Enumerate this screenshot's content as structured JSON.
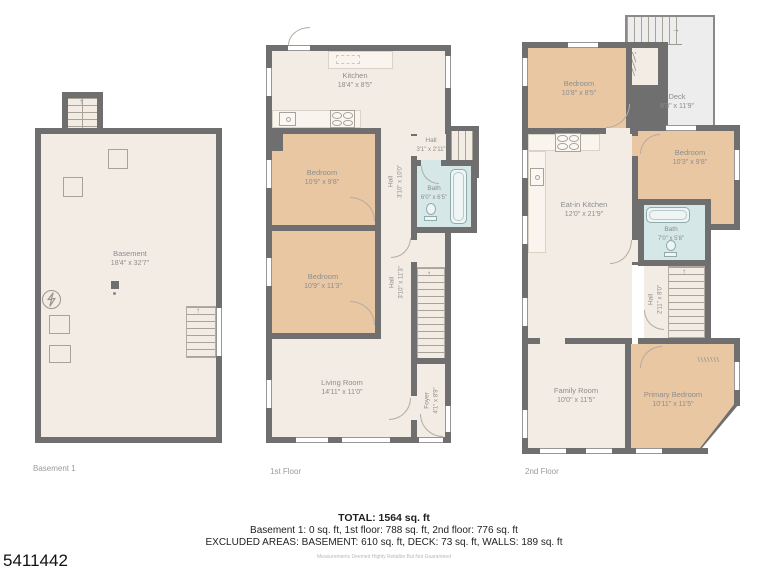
{
  "footer": {
    "total": "TOTAL: 1564 sq. ft",
    "breakdown": "Basement 1: 0 sq. ft, 1st floor: 788 sq. ft, 2nd floor: 776 sq. ft",
    "excluded": "EXCLUDED AREAS: BASEMENT: 610 sq. ft, DECK: 73 sq. ft, WALLS: 189 sq. ft",
    "disclaimer": "Measurements Deemed Highly Reliable But Not Guaranteed",
    "listing_number": "5411442"
  },
  "colors": {
    "wall": "#6f6f6f",
    "floor": "#f2ece5",
    "bedroom": "#eac7a3",
    "bath": "#d5e7e6",
    "deck": "#ededed",
    "label_text": "#8d8d8d"
  },
  "floors": [
    {
      "label": "Basement 1",
      "rooms": [
        {
          "name": "Basement",
          "dims": "18'4\" x 32'7\""
        }
      ]
    },
    {
      "label": "1st Floor",
      "rooms": [
        {
          "name": "Kitchen",
          "dims": "18'4\" x 8'5\""
        },
        {
          "name": "Bedroom",
          "dims": "10'9\" x 9'8\""
        },
        {
          "name": "Bedroom",
          "dims": "10'9\" x 11'3\""
        },
        {
          "name": "Living Room",
          "dims": "14'11\" x 11'0\""
        },
        {
          "name": "Hall",
          "dims": "3'1\" x 2'11\""
        },
        {
          "name": "Bath",
          "dims": "6'0\" x 6'5\""
        },
        {
          "name": "Hall",
          "dims": "3'10\" x 10'0\""
        },
        {
          "name": "Hall",
          "dims": "3'10\" x 11'3\""
        },
        {
          "name": "Foyer",
          "dims": "4'1\" x 8'9\""
        }
      ]
    },
    {
      "label": "2nd Floor",
      "rooms": [
        {
          "name": "Bedroom",
          "dims": "10'8\" x 8'5\""
        },
        {
          "name": "Deck",
          "dims": "8'3\" x 11'9\""
        },
        {
          "name": "Bedroom",
          "dims": "10'3\" x 9'8\""
        },
        {
          "name": "Eat-in Kitchen",
          "dims": "12'0\" x 21'9\""
        },
        {
          "name": "Bath",
          "dims": "7'0\" x 5'8\""
        },
        {
          "name": "Hall",
          "dims": "2'11\" x 8'0\""
        },
        {
          "name": "Family Room",
          "dims": "10'0\" x 11'5\""
        },
        {
          "name": "Primary Bedroom",
          "dims": "10'11\" x 11'5\""
        }
      ]
    }
  ]
}
